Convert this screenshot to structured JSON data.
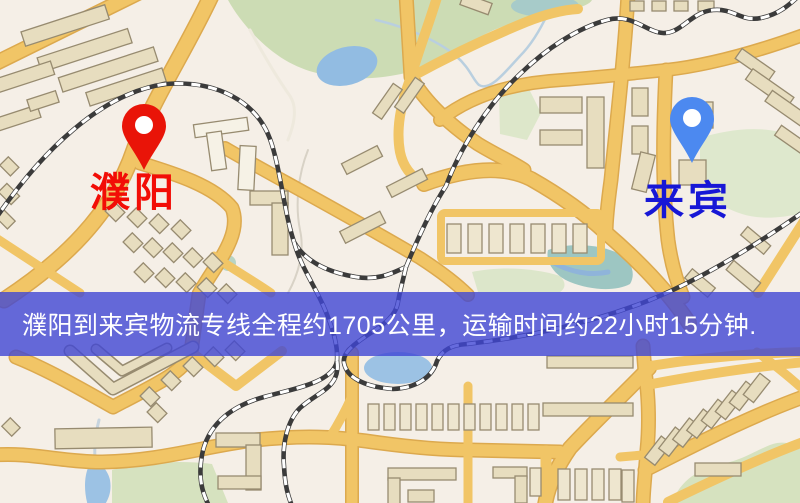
{
  "banner": {
    "text": "濮阳到来宾物流专线全程约1705公里，运输时间约22小时15分钟.",
    "background": "#4046d4",
    "background_opacity": 0.8,
    "text_color": "#ffffff"
  },
  "markers": {
    "origin": {
      "label": "濮阳",
      "label_color": "#f20d06",
      "pin_color": "#e91408"
    },
    "destination": {
      "label": "来宾",
      "label_color": "#1717d6",
      "pin_color": "#4c89f0"
    }
  },
  "map": {
    "colors": {
      "background": "#f5efe7",
      "road": "#f1c566",
      "road_casing": "#dca94e",
      "building": "#e7ddbf",
      "park": "#ccdcb4",
      "water": "#93bce4",
      "railway": "#3b3b3b"
    }
  }
}
